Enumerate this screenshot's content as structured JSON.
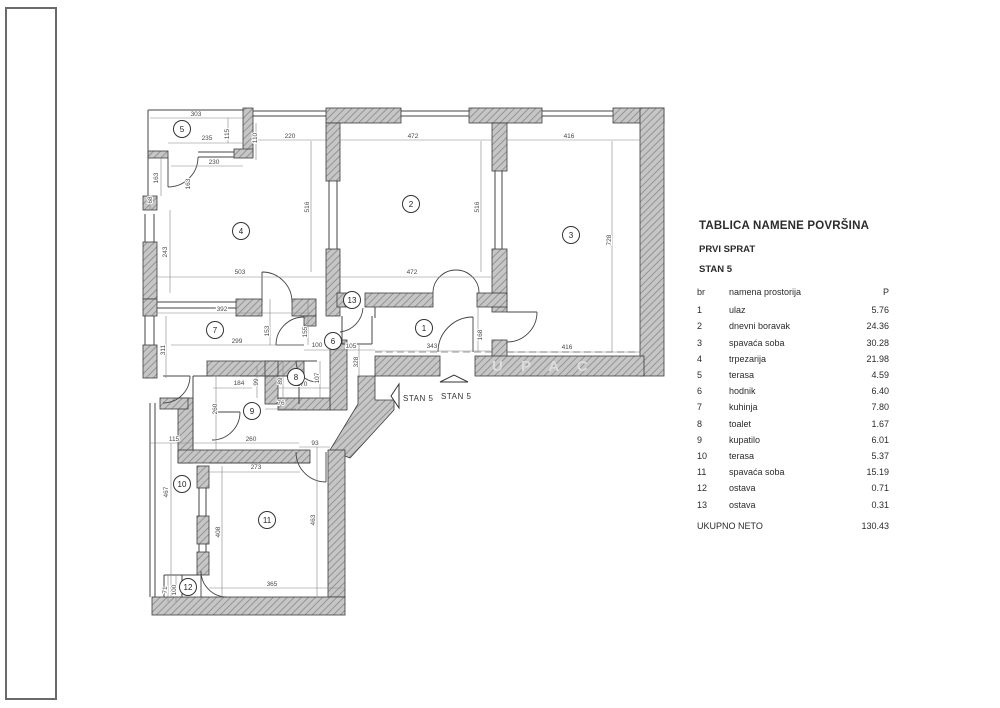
{
  "table": {
    "title": "TABLICA NAMENE POVRŠINA",
    "floor": "PRVI SPRAT",
    "unit": "STAN 5",
    "columns": {
      "br": "br",
      "name": "namena prostorija",
      "area": "P"
    },
    "rows": [
      {
        "br": "1",
        "name": "ulaz",
        "area": "5.76"
      },
      {
        "br": "2",
        "name": "dnevni boravak",
        "area": "24.36"
      },
      {
        "br": "3",
        "name": "spavaća soba",
        "area": "30.28"
      },
      {
        "br": "4",
        "name": "trpezarija",
        "area": "21.98"
      },
      {
        "br": "5",
        "name": "terasa",
        "area": "4.59"
      },
      {
        "br": "6",
        "name": "hodnik",
        "area": "6.40"
      },
      {
        "br": "7",
        "name": "kuhinja",
        "area": "7.80"
      },
      {
        "br": "8",
        "name": "toalet",
        "area": "1.67"
      },
      {
        "br": "9",
        "name": "kupatilo",
        "area": "6.01"
      },
      {
        "br": "10",
        "name": "terasa",
        "area": "5.37"
      },
      {
        "br": "11",
        "name": "spavaća soba",
        "area": "15.19"
      },
      {
        "br": "12",
        "name": "ostava",
        "area": "0.71"
      },
      {
        "br": "13",
        "name": "ostava",
        "area": "0.31"
      }
    ],
    "total_label": "UKUPNO NETO",
    "total_value": "130.43"
  },
  "plan": {
    "watermark": {
      "text": "U P A C",
      "x": 492,
      "y": 371
    },
    "entrance_labels": [
      {
        "text": "STAN 5",
        "arrow": "left",
        "x": 403,
        "y": 401
      },
      {
        "text": "STAN 5",
        "arrow": "up",
        "x": 441,
        "y": 399
      }
    ],
    "rooms": [
      {
        "n": "1",
        "x": 424,
        "y": 328
      },
      {
        "n": "2",
        "x": 411,
        "y": 204
      },
      {
        "n": "3",
        "x": 571,
        "y": 235
      },
      {
        "n": "4",
        "x": 241,
        "y": 231
      },
      {
        "n": "5",
        "x": 182,
        "y": 129
      },
      {
        "n": "6",
        "x": 333,
        "y": 341
      },
      {
        "n": "7",
        "x": 215,
        "y": 330
      },
      {
        "n": "8",
        "x": 296,
        "y": 377
      },
      {
        "n": "9",
        "x": 252,
        "y": 411
      },
      {
        "n": "10",
        "x": 182,
        "y": 484
      },
      {
        "n": "11",
        "x": 267,
        "y": 520
      },
      {
        "n": "12",
        "x": 188,
        "y": 587
      },
      {
        "n": "13",
        "x": 352,
        "y": 300
      }
    ],
    "dims": [
      {
        "t": "303",
        "x": 196,
        "y": 116,
        "v": false
      },
      {
        "t": "235",
        "x": 207,
        "y": 140,
        "v": false
      },
      {
        "t": "115",
        "x": 229,
        "y": 134,
        "v": true
      },
      {
        "t": "110",
        "x": 257,
        "y": 138,
        "v": true
      },
      {
        "t": "220",
        "x": 290,
        "y": 138,
        "v": false
      },
      {
        "t": "230",
        "x": 214,
        "y": 164,
        "v": false
      },
      {
        "t": "163",
        "x": 158,
        "y": 178,
        "v": true
      },
      {
        "t": "163",
        "x": 190,
        "y": 184,
        "v": true
      },
      {
        "t": "68",
        "x": 152,
        "y": 200,
        "v": true
      },
      {
        "t": "243",
        "x": 167,
        "y": 252,
        "v": true
      },
      {
        "t": "503",
        "x": 240,
        "y": 274,
        "v": false
      },
      {
        "t": "516",
        "x": 309,
        "y": 207,
        "v": true
      },
      {
        "t": "472",
        "x": 413,
        "y": 138,
        "v": false
      },
      {
        "t": "416",
        "x": 569,
        "y": 138,
        "v": false
      },
      {
        "t": "516",
        "x": 479,
        "y": 207,
        "v": true
      },
      {
        "t": "728",
        "x": 611,
        "y": 240,
        "v": true
      },
      {
        "t": "472",
        "x": 412,
        "y": 274,
        "v": false
      },
      {
        "t": "392",
        "x": 222,
        "y": 311,
        "v": false
      },
      {
        "t": "311",
        "x": 165,
        "y": 350,
        "v": true
      },
      {
        "t": "299",
        "x": 237,
        "y": 343,
        "v": false
      },
      {
        "t": "153",
        "x": 269,
        "y": 331,
        "v": true
      },
      {
        "t": "155",
        "x": 307,
        "y": 332,
        "v": true
      },
      {
        "t": "100",
        "x": 317,
        "y": 347,
        "v": false
      },
      {
        "t": "105",
        "x": 351,
        "y": 348,
        "v": false
      },
      {
        "t": "328",
        "x": 358,
        "y": 362,
        "v": true
      },
      {
        "t": "343",
        "x": 432,
        "y": 348,
        "v": false
      },
      {
        "t": "168",
        "x": 482,
        "y": 335,
        "v": true
      },
      {
        "t": "416",
        "x": 567,
        "y": 349,
        "v": false
      },
      {
        "t": "184",
        "x": 239,
        "y": 385,
        "v": false
      },
      {
        "t": "99",
        "x": 258,
        "y": 382,
        "v": true
      },
      {
        "t": "89",
        "x": 282,
        "y": 381,
        "v": true
      },
      {
        "t": "170",
        "x": 302,
        "y": 386,
        "v": false
      },
      {
        "t": "107",
        "x": 319,
        "y": 378,
        "v": true
      },
      {
        "t": "76",
        "x": 281,
        "y": 405,
        "v": false
      },
      {
        "t": "260",
        "x": 217,
        "y": 409,
        "v": true
      },
      {
        "t": "260",
        "x": 251,
        "y": 441,
        "v": false
      },
      {
        "t": "115",
        "x": 174,
        "y": 441,
        "v": false
      },
      {
        "t": "93",
        "x": 315,
        "y": 445,
        "v": false
      },
      {
        "t": "273",
        "x": 256,
        "y": 469,
        "v": false
      },
      {
        "t": "467",
        "x": 168,
        "y": 492,
        "v": true
      },
      {
        "t": "408",
        "x": 220,
        "y": 532,
        "v": true
      },
      {
        "t": "463",
        "x": 315,
        "y": 520,
        "v": true
      },
      {
        "t": "365",
        "x": 272,
        "y": 586,
        "v": false
      },
      {
        "t": "71",
        "x": 167,
        "y": 590,
        "v": true
      },
      {
        "t": "100",
        "x": 176,
        "y": 590,
        "v": true
      }
    ]
  }
}
